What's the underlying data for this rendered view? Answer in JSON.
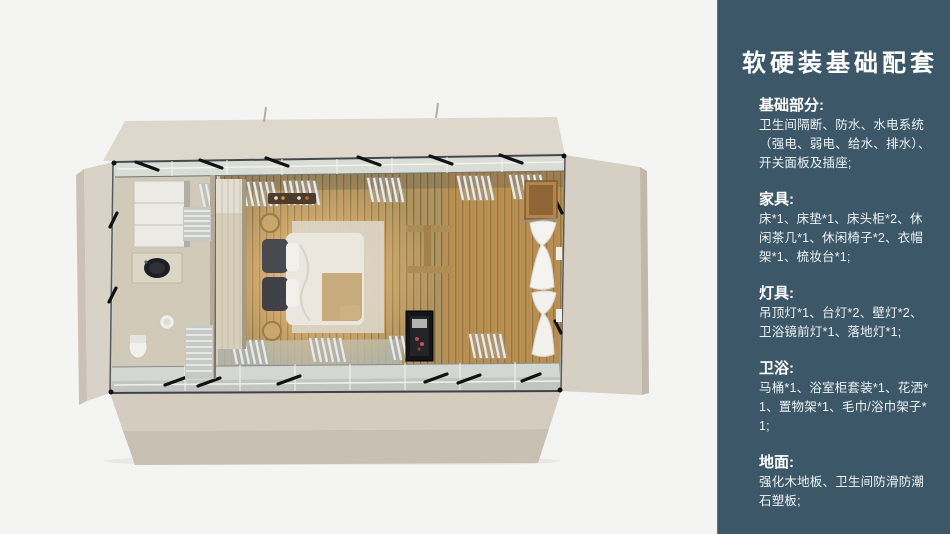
{
  "page": {
    "background_color": "#f4f4f3"
  },
  "panel": {
    "background_color": "#3c5768",
    "text_color": "#ffffff",
    "title": "软硬装基础配套",
    "sections": [
      {
        "heading": "基础部分:",
        "body": "卫生间隔断、防水、水电系统（强电、弱电、给水、排水）、开关面板及插座;"
      },
      {
        "heading": "家具:",
        "body": "床*1、床垫*1、床头柜*2、休闲茶几*1、休闲椅子*2、衣帽架*1、梳妆台*1;"
      },
      {
        "heading": "灯具:",
        "body": "吊顶灯*1、台灯*2、壁灯*2、卫浴镜前灯*1、落地灯*1;"
      },
      {
        "heading": "卫浴:",
        "body": "马桶*1、浴室柜套装*1、花洒*1、置物架*1、毛巾/浴巾架子*1;"
      },
      {
        "heading": "地面:",
        "body": "强化木地板、卫生间防滑防潮石塑板;"
      }
    ]
  },
  "floor_plan": {
    "description": "俯视卧室+卫生间集装箱房效果图",
    "colors": {
      "flap_beige": "#d8d1c5",
      "wood_floor": "#b29561",
      "wood_floor_warm": "#c8883e",
      "frame_dark": "#15171a",
      "tile": "#d1cab8",
      "glow": "#ffe3b3"
    }
  }
}
